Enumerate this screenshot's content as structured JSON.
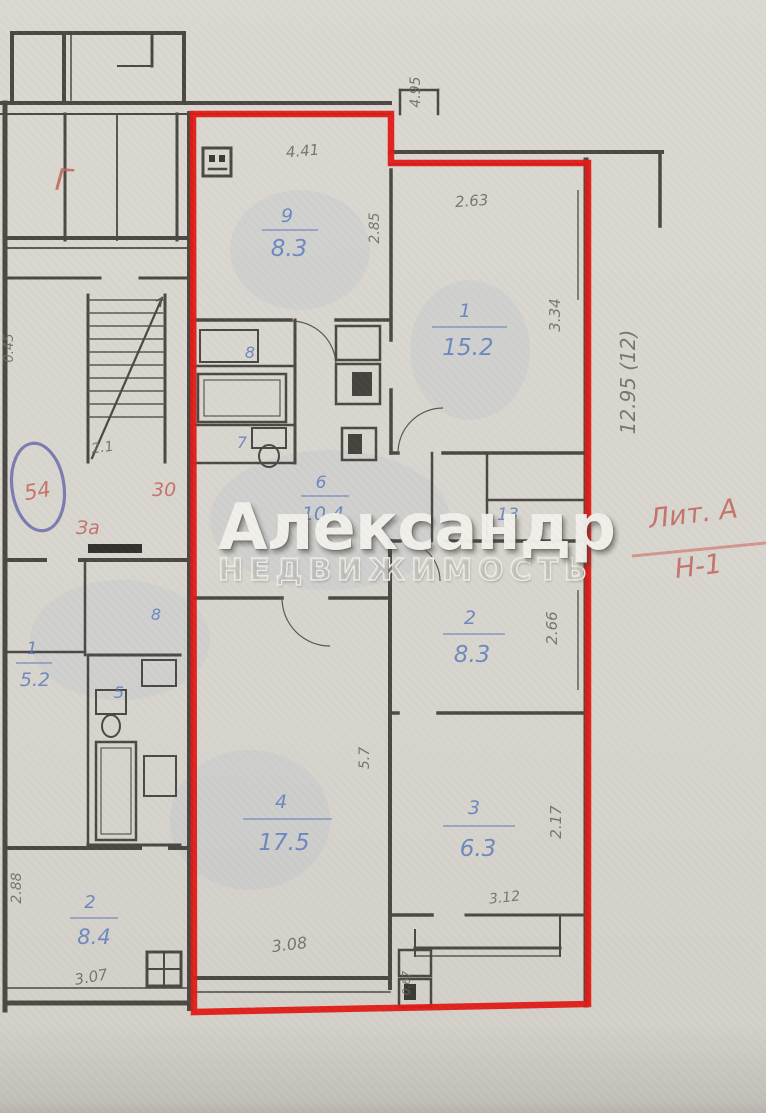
{
  "watermark": {
    "title": "Александр",
    "subtitle": "НЕДВИЖИМОСТЬ"
  },
  "apartment": {
    "rooms": {
      "kitchen": {
        "num": "9",
        "area": "8.3"
      },
      "room1": {
        "num": "1",
        "area": "15.2"
      },
      "room2": {
        "num": "2",
        "area": "8.3"
      },
      "room3": {
        "num": "3",
        "area": "6.3"
      },
      "room4": {
        "num": "4",
        "area": "17.5"
      },
      "corridor": {
        "num": "6",
        "area": "10.4"
      },
      "wc": {
        "num": "7"
      },
      "closet": {
        "num": "8"
      },
      "hall": {
        "num": "13"
      }
    },
    "dims": {
      "top_width": "4.95",
      "kitchen_top": "4.41",
      "kitchen_side": "2.85",
      "room1_width": "2.63",
      "room1_side": "3.34",
      "room2_side": "2.66",
      "room3_side": "2.17",
      "room4_inner": "5.7",
      "room4_bottom": "3.08",
      "balcony_width": "3.12",
      "balcony_side": "0.67"
    }
  },
  "neighbor": {
    "rooms": {
      "room1": {
        "num": "1",
        "area": "5.2"
      },
      "room2": {
        "num": "2",
        "area": "8.4"
      },
      "closet": {
        "num": "8"
      },
      "wc": {
        "num": "5"
      }
    },
    "dims": {
      "room2_side": "2.88",
      "room2_bottom": "3.07",
      "left_edge": "0.45",
      "landing": "2.1"
    }
  },
  "annotations": {
    "section_height": "12.95 (12)",
    "liter": "Лит. А",
    "building_line": "Н-1",
    "mark_g": "Г",
    "num_30": "30",
    "num_za": "За",
    "stamp_num": "54"
  }
}
